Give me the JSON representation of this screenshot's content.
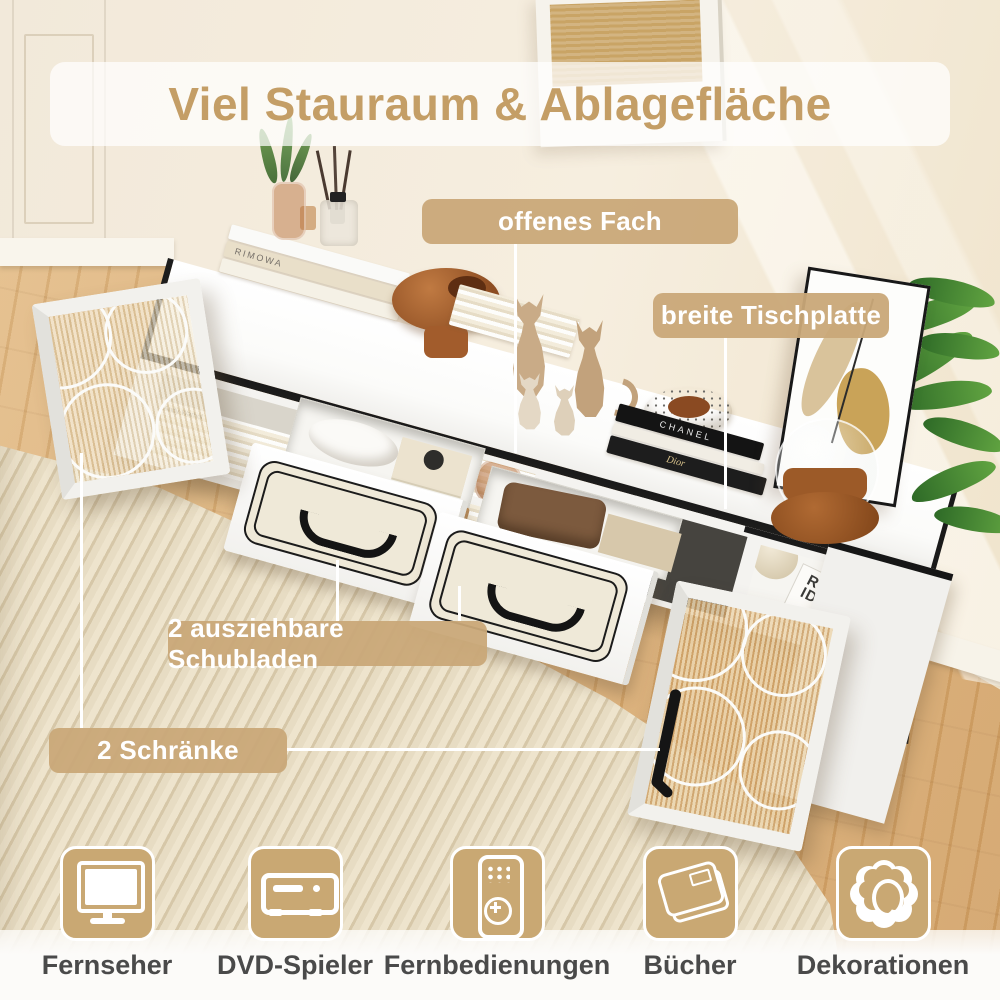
{
  "banner": {
    "title": "Viel Stauraum & Ablagefläche"
  },
  "callouts": {
    "open_shelf": "offenes Fach",
    "tabletop": "breite Tischplatte",
    "drawers": "2 ausziehbare Schubladen",
    "cabinets": "2 Schränke"
  },
  "features": [
    {
      "icon": "tv-icon",
      "label": "Fernseher"
    },
    {
      "icon": "dvd-player-icon",
      "label": "DVD-Spieler"
    },
    {
      "icon": "remote-control-icon",
      "label": "Fernbedienungen"
    },
    {
      "icon": "book-icon",
      "label": "Bücher"
    },
    {
      "icon": "flower-icon",
      "label": "Dekorationen"
    }
  ],
  "decor_texts": {
    "book_rimowa": "RIMOWA",
    "book_warhol": "Andy Warhol",
    "book_chanel": "CHANEL",
    "book_dior": "Dior",
    "book_raum_line1": "RAUM",
    "book_raum_line2": "IDEEN"
  },
  "colors": {
    "accent_gold": "#c49e66",
    "label_bg": "#c8a878",
    "icon_bg": "#c9a873",
    "feature_text": "#4a4a4a",
    "connector_line": "#ffffff",
    "furniture_trim": "#1b1b1b"
  }
}
